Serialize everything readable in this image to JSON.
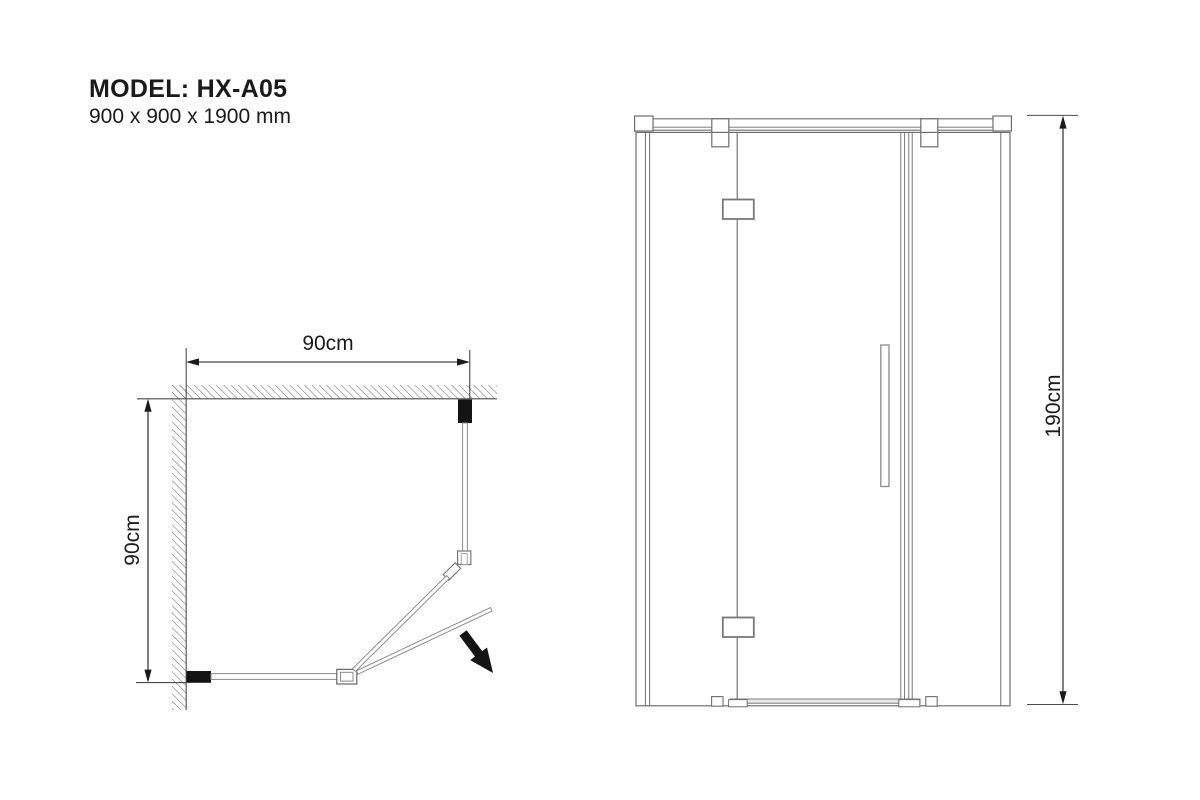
{
  "title_block": {
    "model_label": "MODEL: HX-A05",
    "size_label": "900 x 900 x 1900 mm"
  },
  "plan_view": {
    "width_label": "90cm",
    "depth_label": "90cm"
  },
  "elevation_view": {
    "height_label": "190cm"
  },
  "icons": {
    "door_swing_arrow": "solid black diagonal arrow pointing down-right"
  },
  "colors": {
    "background": "#ffffff",
    "structure_line": "#6e6e6e",
    "wall_face_line": "#4d4d4d",
    "hatch_line": "#6a6a6a",
    "dimension_line": "#1a1a1a",
    "wall_profile_fill": "#141414",
    "text": "#1a1a1a"
  }
}
